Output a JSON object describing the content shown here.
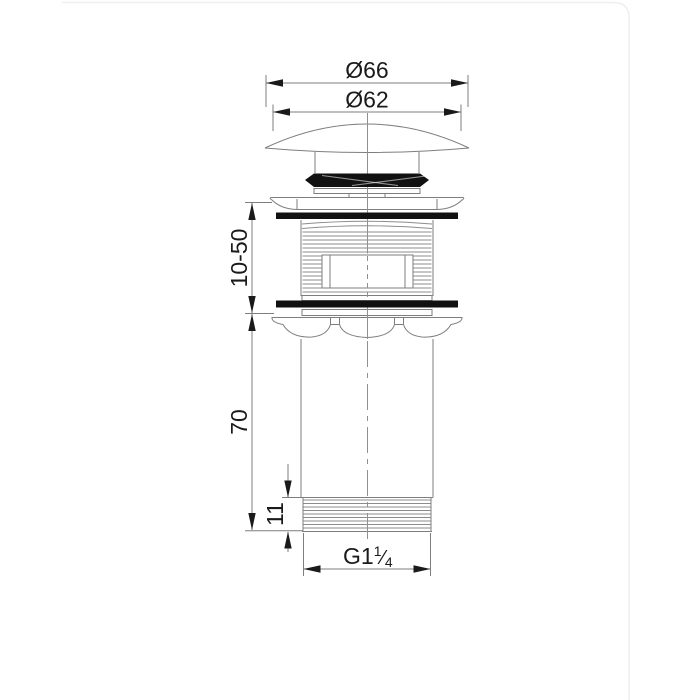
{
  "drawing": {
    "labels": {
      "outer_diameter": "Ø66",
      "inner_diameter": "Ø62",
      "clamp_range": "10-50",
      "body_length": "70",
      "thread_length": "11",
      "thread_size_prefix": "G1",
      "thread_size_numerator": "1",
      "thread_size_slash": "⁄",
      "thread_size_denominator": "4"
    },
    "colors": {
      "line": "#7e7e7e",
      "ink": "#1a1a1a",
      "rubber_fill": "#111111",
      "paper": "#ffffff",
      "card_border": "#efefef"
    }
  }
}
